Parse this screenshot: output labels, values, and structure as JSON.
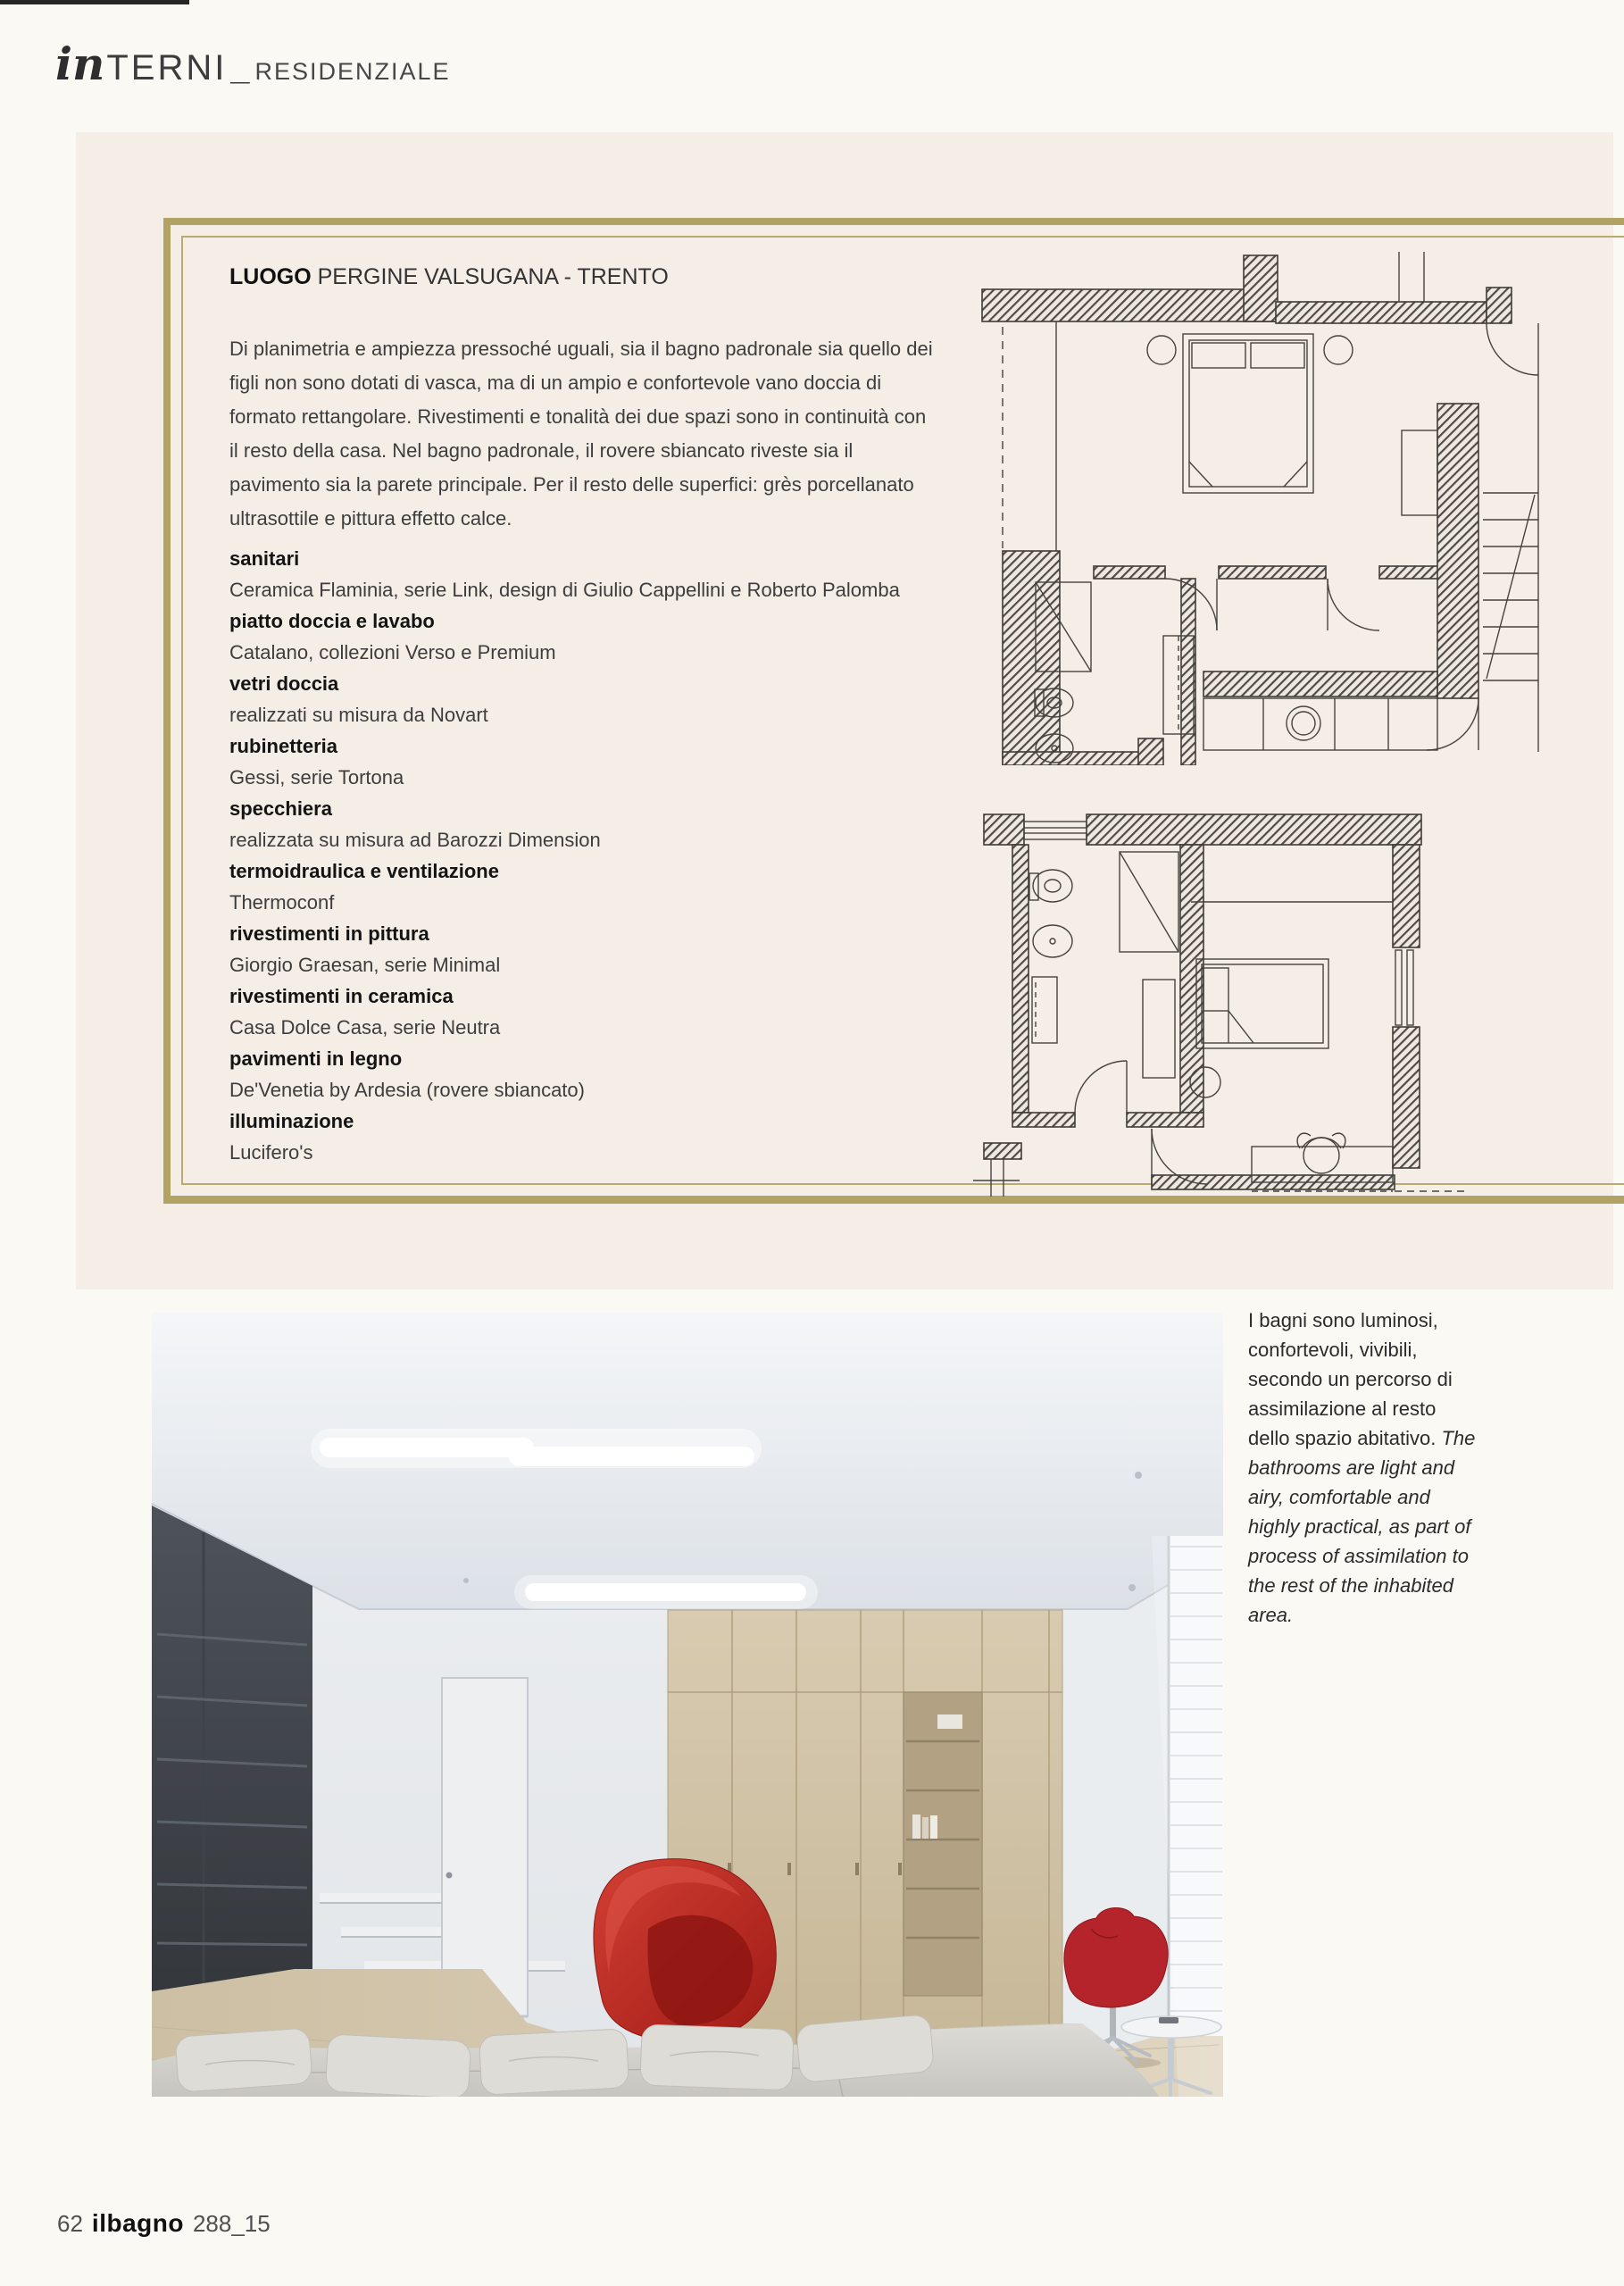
{
  "header": {
    "brand_italic": "in",
    "brand_rest": "TERNI",
    "separator": "_",
    "section": "RESIDENZIALE"
  },
  "article": {
    "location_label": "LUOGO",
    "location_value": "PERGINE VALSUGANA - TRENTO",
    "intro": "Di planimetria e ampiezza pressoché uguali, sia il bagno padronale sia quello dei figli non sono dotati di vasca, ma di un ampio e confortevole vano doccia di formato rettangolare. Rivestimenti e tonalità dei due spazi sono in continuità con il resto della casa. Nel bagno padronale, il rovere sbiancato riveste sia il pavimento sia la parete principale. Per il resto delle superfici: grès porcellanato ultrasottile e pittura effetto calce.",
    "credits": [
      {
        "label": "sanitari",
        "value": "Ceramica Flaminia, serie Link, design di Giulio Cappellini e Roberto Palomba"
      },
      {
        "label": "piatto doccia e lavabo",
        "value": "Catalano, collezioni Verso e Premium"
      },
      {
        "label": "vetri doccia",
        "value": "realizzati su misura da Novart"
      },
      {
        "label": "rubinetteria",
        "value": "Gessi, serie Tortona"
      },
      {
        "label": "specchiera",
        "value": "realizzata su misura ad Barozzi Dimension"
      },
      {
        "label": "termoidraulica e ventilazione",
        "value": "Thermoconf"
      },
      {
        "label": "rivestimenti in pittura",
        "value": "Giorgio Graesan, serie Minimal"
      },
      {
        "label": "rivestimenti in ceramica",
        "value": "Casa Dolce Casa, serie Neutra"
      },
      {
        "label": "pavimenti in legno",
        "value": "De'Venetia by Ardesia (rovere sbiancato)"
      },
      {
        "label": "illuminazione",
        "value": "Lucifero's"
      }
    ]
  },
  "caption": {
    "italian": "I bagni sono luminosi, confortevoli, vivibili, secondo un percorso di assimilazione al resto dello spazio abitativo.",
    "english": "The bathrooms are light and airy, comfortable and highly practical, as part of process of assimilation to the rest of the inhabited area."
  },
  "footer": {
    "page_number": "62",
    "magazine": "ilbagno",
    "issue": "288_15"
  },
  "colors": {
    "gold": "#b2a264",
    "panel": "#f5eee7",
    "page": "#fbf9f4",
    "accent_red": "#c0231f"
  }
}
